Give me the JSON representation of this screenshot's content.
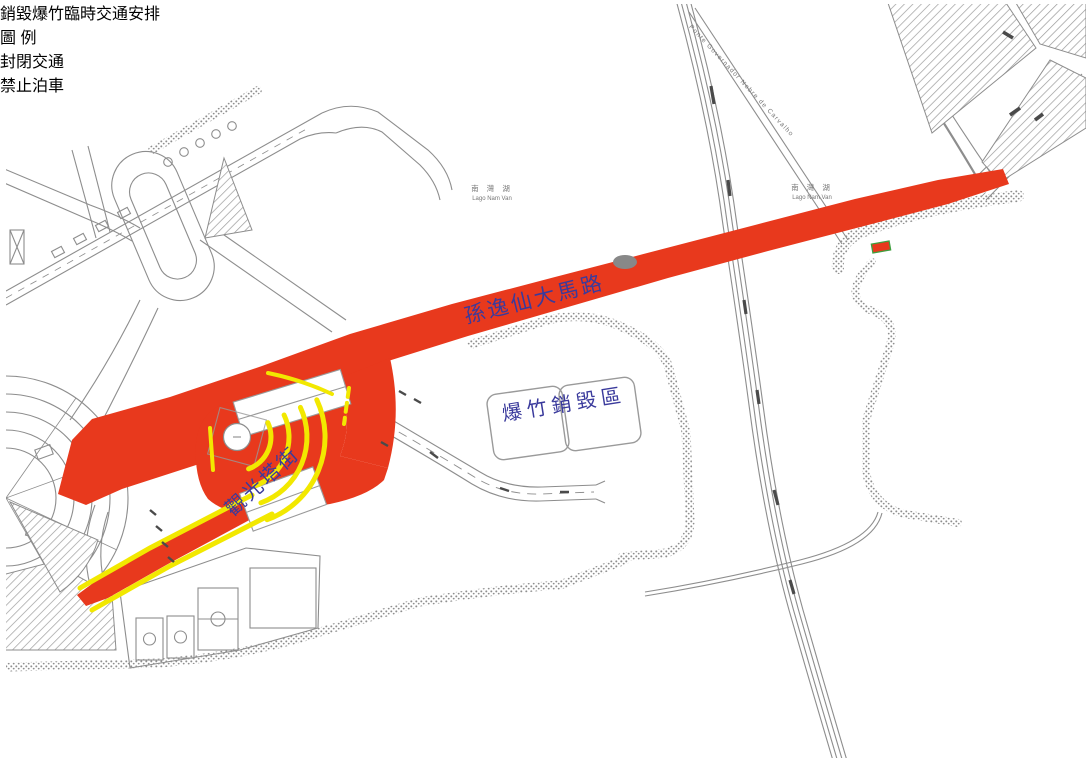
{
  "page": {
    "background": "#ffffff",
    "border_color": "#8f8f8f"
  },
  "map": {
    "colors": {
      "closed_traffic": "#e8391d",
      "no_parking": "#f2e800",
      "linework": "#8d8d8d",
      "label_blue": "#3a3a9c"
    },
    "labels": {
      "main_road": "孫逸仙大馬路",
      "destruction_zone": "爆竹銷毀區",
      "tower_street": "觀光塔街",
      "bridge": "Ponte Governador Nobre de Carvalho",
      "lake_cn": "南 灣 湖",
      "lake_pt": "Lago Nam Van"
    }
  },
  "legend": {
    "title": "銷毀爆竹臨時交通安排",
    "heading": "圖 例",
    "items": [
      {
        "name": "closed-traffic",
        "label": "封閉交通",
        "color": "#e8391d"
      },
      {
        "name": "no-parking",
        "label": "禁止泊車",
        "color": "#f2e800"
      }
    ]
  }
}
